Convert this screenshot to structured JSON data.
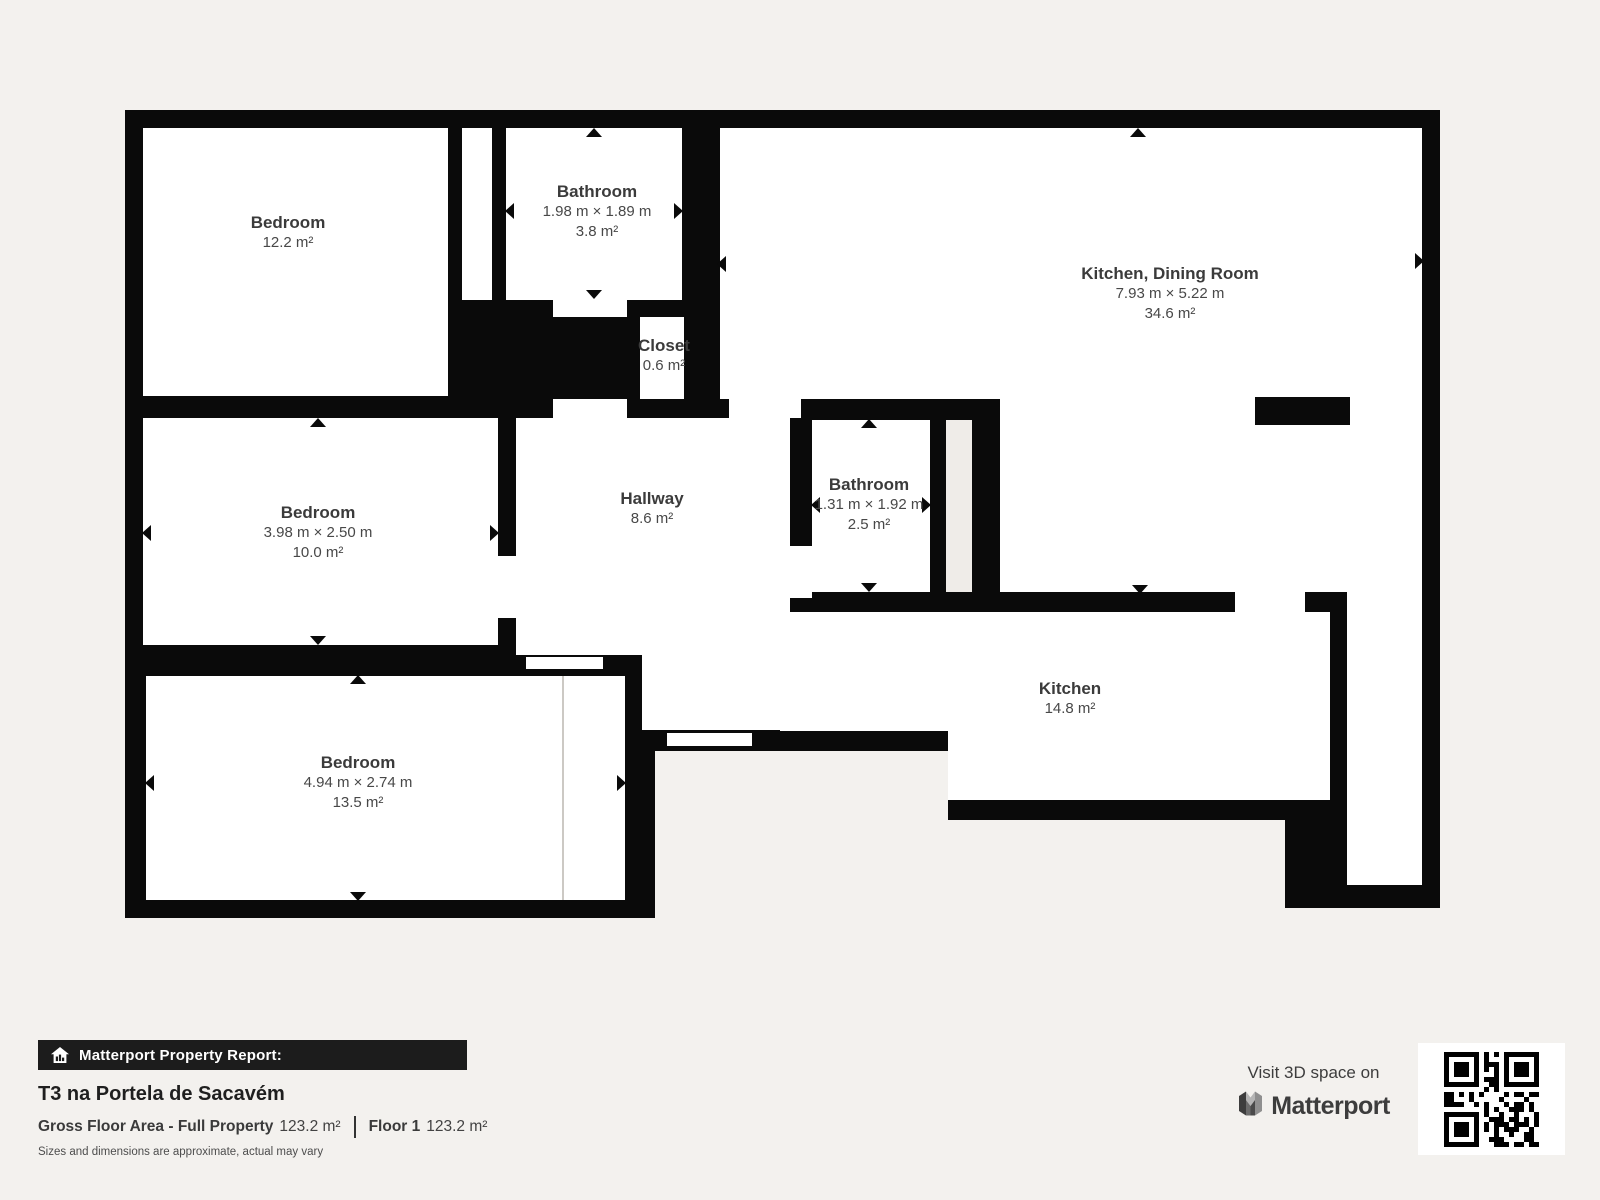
{
  "plan": {
    "rooms": [
      {
        "name": "Bedroom",
        "dims": "",
        "area": "12.2 m²"
      },
      {
        "name": "Bathroom",
        "dims": "1.98 m × 1.89 m",
        "area": "3.8 m²"
      },
      {
        "name": "Kitchen, Dining Room",
        "dims": "7.93 m × 5.22 m",
        "area": "34.6 m²"
      },
      {
        "name": "Closet",
        "dims": "",
        "area": "0.6 m²"
      },
      {
        "name": "Bedroom",
        "dims": "3.98 m × 2.50 m",
        "area": "10.0 m²"
      },
      {
        "name": "Hallway",
        "dims": "",
        "area": "8.6 m²"
      },
      {
        "name": "Bathroom",
        "dims": "1.31 m × 1.92 m",
        "area": "2.5 m²"
      },
      {
        "name": "Kitchen",
        "dims": "",
        "area": "14.8 m²"
      },
      {
        "name": "Bedroom",
        "dims": "4.94 m × 2.74 m",
        "area": "13.5 m²"
      }
    ]
  },
  "report": {
    "banner": "Matterport Property Report:",
    "title": "T3 na Portela de Sacavém",
    "gross_label": "Gross Floor Area - Full Property",
    "gross_value": "123.2 m²",
    "floor_label": "Floor 1",
    "floor_value": "123.2 m²",
    "disclaimer": "Sizes and dimensions are approximate, actual may vary"
  },
  "cta": {
    "line": "Visit 3D space on",
    "brand": "Matterport"
  },
  "colors": {
    "background": "#f3f1ee",
    "wall": "#0a0a0a",
    "floor": "#ffffff",
    "shaft": "#efece8",
    "label_text": "#3e3e3e",
    "banner_bg": "#1c1c1c"
  }
}
